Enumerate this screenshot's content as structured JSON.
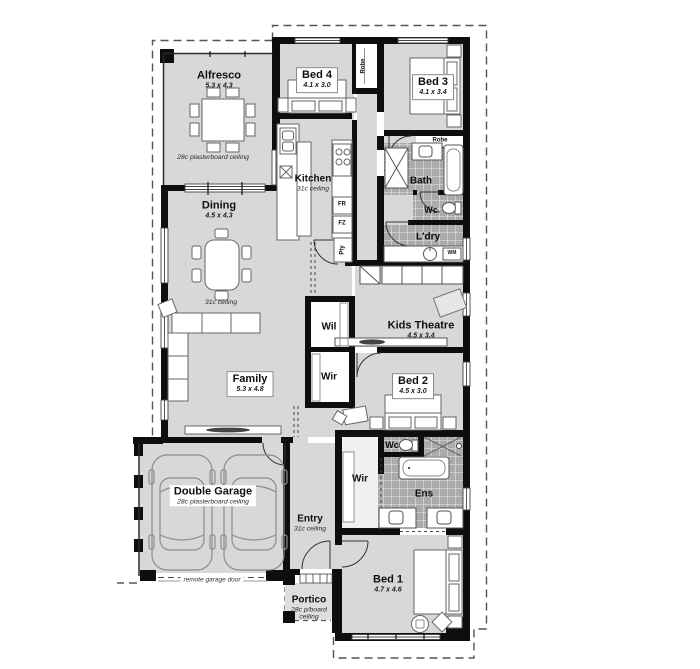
{
  "plan_type": "single-storey house floor plan",
  "rooms": {
    "alfresco": {
      "name": "Alfresco",
      "dims": "5.3 x 4.3",
      "ceiling": "28c plasterboard ceiling"
    },
    "bed4": {
      "name": "Bed 4",
      "dims": "4.1 x 3.0"
    },
    "bed3": {
      "name": "Bed 3",
      "dims": "4.1 x 3.4"
    },
    "kitchen": {
      "name": "Kitchen",
      "ceiling": "31c ceiling"
    },
    "bath": {
      "name": "Bath"
    },
    "wc_upper": {
      "name": "Wc"
    },
    "laundry": {
      "name": "L'dry"
    },
    "dining": {
      "name": "Dining",
      "dims": "4.5 x 4.3",
      "ceiling": "31c ceiling"
    },
    "linen": {
      "name": "Wil"
    },
    "kids_theatre": {
      "name": "Kids Theatre",
      "dims": "4.5 x 3.4"
    },
    "wir_bed2": {
      "name": "Wir"
    },
    "family": {
      "name": "Family",
      "dims": "5.3 x 4.8"
    },
    "bed2": {
      "name": "Bed 2",
      "dims": "4.5 x 3.0"
    },
    "wc_ens": {
      "name": "Wc"
    },
    "wir_bed1": {
      "name": "Wir"
    },
    "ens": {
      "name": "Ens"
    },
    "garage": {
      "name": "Double Garage",
      "ceiling": "28c plasterboard ceiling",
      "door_note": "remote garage door"
    },
    "entry": {
      "name": "Entry",
      "ceiling": "31c ceiling"
    },
    "portico": {
      "name": "Portico",
      "ceiling_line1": "28c p/board",
      "ceiling_line2": "ceiling"
    },
    "bed1": {
      "name": "Bed 1",
      "dims": "4.7 x 4.6"
    }
  },
  "fixtures": {
    "robe_bed4": "Robe",
    "robe_bed3": "Robe",
    "fridge": "FR",
    "freezer": "FZ",
    "pantry": "Pty",
    "washing_machine": "WM"
  },
  "colors": {
    "floor": "#d8d8d8",
    "portico_floor": "#dedede",
    "wall": "#0e0e0e",
    "tile": "#ababab",
    "boundary": "#555555"
  }
}
